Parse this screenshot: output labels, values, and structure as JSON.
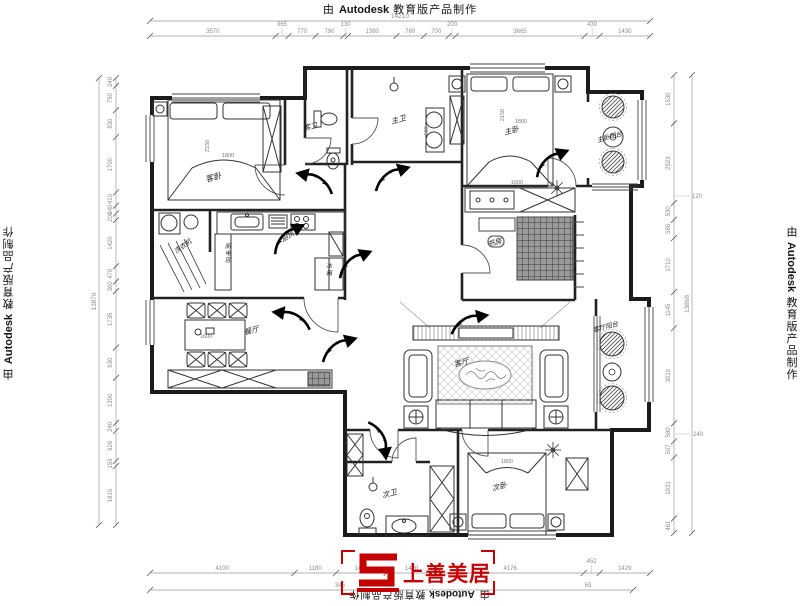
{
  "title": {
    "prefix": "由",
    "brand": "Autodesk",
    "suffix": "教育版产品制作"
  },
  "logo": {
    "text": "上善美居",
    "color": "#c40000"
  },
  "dimensions": {
    "top_total": "14210",
    "top_chain": [
      "3570",
      "365",
      "770",
      "790",
      "130",
      "1380",
      "780",
      "700",
      "200",
      "3665",
      "430",
      "1430"
    ],
    "left_total": "13870",
    "left_chain": [
      "240",
      "750",
      "830",
      "1700",
      "410",
      "240",
      "200",
      "1420",
      "470",
      "300",
      "1735",
      "930",
      "1390",
      "240",
      "926",
      "159",
      "1815"
    ],
    "right_total": "13868",
    "right_chain": [
      "1530",
      "2523",
      "530",
      "580",
      "1710",
      "1145",
      "3010",
      "580",
      "507",
      "1931",
      "461"
    ],
    "right_floats": [
      "120",
      "240"
    ],
    "bottom_chain": [
      "4100",
      "1180",
      "1435",
      "1420",
      "4176",
      "452",
      "1429"
    ],
    "bottom_subs": [
      "345",
      "59"
    ]
  },
  "rooms": [
    {
      "id": "guest-bedroom",
      "label": "客卧",
      "x": 214,
      "y": 180,
      "rot": -15,
      "fs": 8
    },
    {
      "id": "guest-bath",
      "label": "客卫",
      "x": 311,
      "y": 129,
      "rot": -15,
      "fs": 7
    },
    {
      "id": "master-bath",
      "label": "主卫",
      "x": 399,
      "y": 122,
      "rot": -15,
      "fs": 7.5
    },
    {
      "id": "master-bedroom",
      "label": "主卧",
      "x": 512,
      "y": 133,
      "rot": -15,
      "fs": 7.5
    },
    {
      "id": "master-balcony",
      "label": "主卧阳台",
      "x": 610,
      "y": 139,
      "rot": -15,
      "fs": 6.5
    },
    {
      "id": "study",
      "label": "书房",
      "x": 495,
      "y": 245,
      "rot": -15,
      "fs": 7.5
    },
    {
      "id": "kitchen",
      "label": "厨房",
      "x": 289,
      "y": 238,
      "rot": -35,
      "fs": 7
    },
    {
      "id": "kitchen-appliance-zone",
      "label": "厨电区",
      "x": 228,
      "y": 248,
      "vertical": true,
      "fs": 6
    },
    {
      "id": "laundry",
      "label": "洗衣机",
      "x": 184,
      "y": 248,
      "rot": -35,
      "fs": 6.5
    },
    {
      "id": "fridge",
      "label": "冰箱",
      "x": 329,
      "y": 268,
      "vertical": true,
      "fs": 6
    },
    {
      "id": "dining",
      "label": "餐厅",
      "x": 252,
      "y": 333,
      "rot": -15,
      "fs": 7.5
    },
    {
      "id": "living",
      "label": "客厅",
      "x": 462,
      "y": 365,
      "rot": -15,
      "fs": 7.5
    },
    {
      "id": "living-balcony",
      "label": "客厅阳台",
      "x": 606,
      "y": 329,
      "rot": -15,
      "fs": 6.5
    },
    {
      "id": "second-bath",
      "label": "次卫",
      "x": 390,
      "y": 496,
      "rot": -15,
      "fs": 7.5
    },
    {
      "id": "second-bedroom",
      "label": "次卧",
      "x": 500,
      "y": 489,
      "rot": -15,
      "fs": 7.5
    }
  ],
  "furniture_dims": [
    {
      "text": "2150",
      "x": 209,
      "y": 146,
      "rot": -90
    },
    {
      "text": "1800",
      "x": 228,
      "y": 157,
      "rot": 0
    },
    {
      "text": "2150",
      "x": 504,
      "y": 115,
      "rot": -90
    },
    {
      "text": "1800",
      "x": 521,
      "y": 123,
      "rot": 0
    },
    {
      "text": "1600",
      "x": 517,
      "y": 184,
      "rot": 0
    },
    {
      "text": "600",
      "x": 428,
      "y": 131,
      "rot": -90
    },
    {
      "text": "1600",
      "x": 206,
      "y": 338,
      "rot": 0
    },
    {
      "text": "1800",
      "x": 507,
      "y": 463,
      "rot": 0
    }
  ],
  "arrows": [
    {
      "x": 318,
      "y": 184,
      "rot": 15,
      "flip": -1
    },
    {
      "x": 389,
      "y": 180,
      "rot": -20,
      "flip": 1
    },
    {
      "x": 549,
      "y": 165,
      "rot": -25,
      "flip": 1
    },
    {
      "x": 352,
      "y": 266,
      "rot": -25,
      "flip": 1
    },
    {
      "x": 295,
      "y": 321,
      "rot": 10,
      "flip": -1
    },
    {
      "x": 336,
      "y": 351,
      "rot": -20,
      "flip": 1
    },
    {
      "x": 377,
      "y": 437,
      "rot": 80,
      "flip": 1
    },
    {
      "x": 466,
      "y": 325,
      "rot": -12,
      "flip": 1
    },
    {
      "x": 286,
      "y": 241,
      "rot": -30,
      "flip": 1
    }
  ],
  "plants": [
    {
      "type": "hatch",
      "x": 613,
      "y": 107,
      "r": 11
    },
    {
      "type": "ring",
      "x": 613,
      "y": 137,
      "r": 10
    },
    {
      "type": "hatch",
      "x": 613,
      "y": 162,
      "r": 11
    },
    {
      "type": "hatch",
      "x": 612,
      "y": 344,
      "r": 12
    },
    {
      "type": "ring",
      "x": 612,
      "y": 372,
      "r": 9
    },
    {
      "type": "hatch",
      "x": 612,
      "y": 398,
      "r": 12
    },
    {
      "type": "star",
      "x": 557,
      "y": 188,
      "r": 8
    },
    {
      "type": "star",
      "x": 553,
      "y": 450,
      "r": 8
    },
    {
      "type": "lamp",
      "x": 394,
      "y": 87,
      "r": 4
    },
    {
      "type": "lamp",
      "x": 373,
      "y": 487,
      "r": 4
    }
  ]
}
